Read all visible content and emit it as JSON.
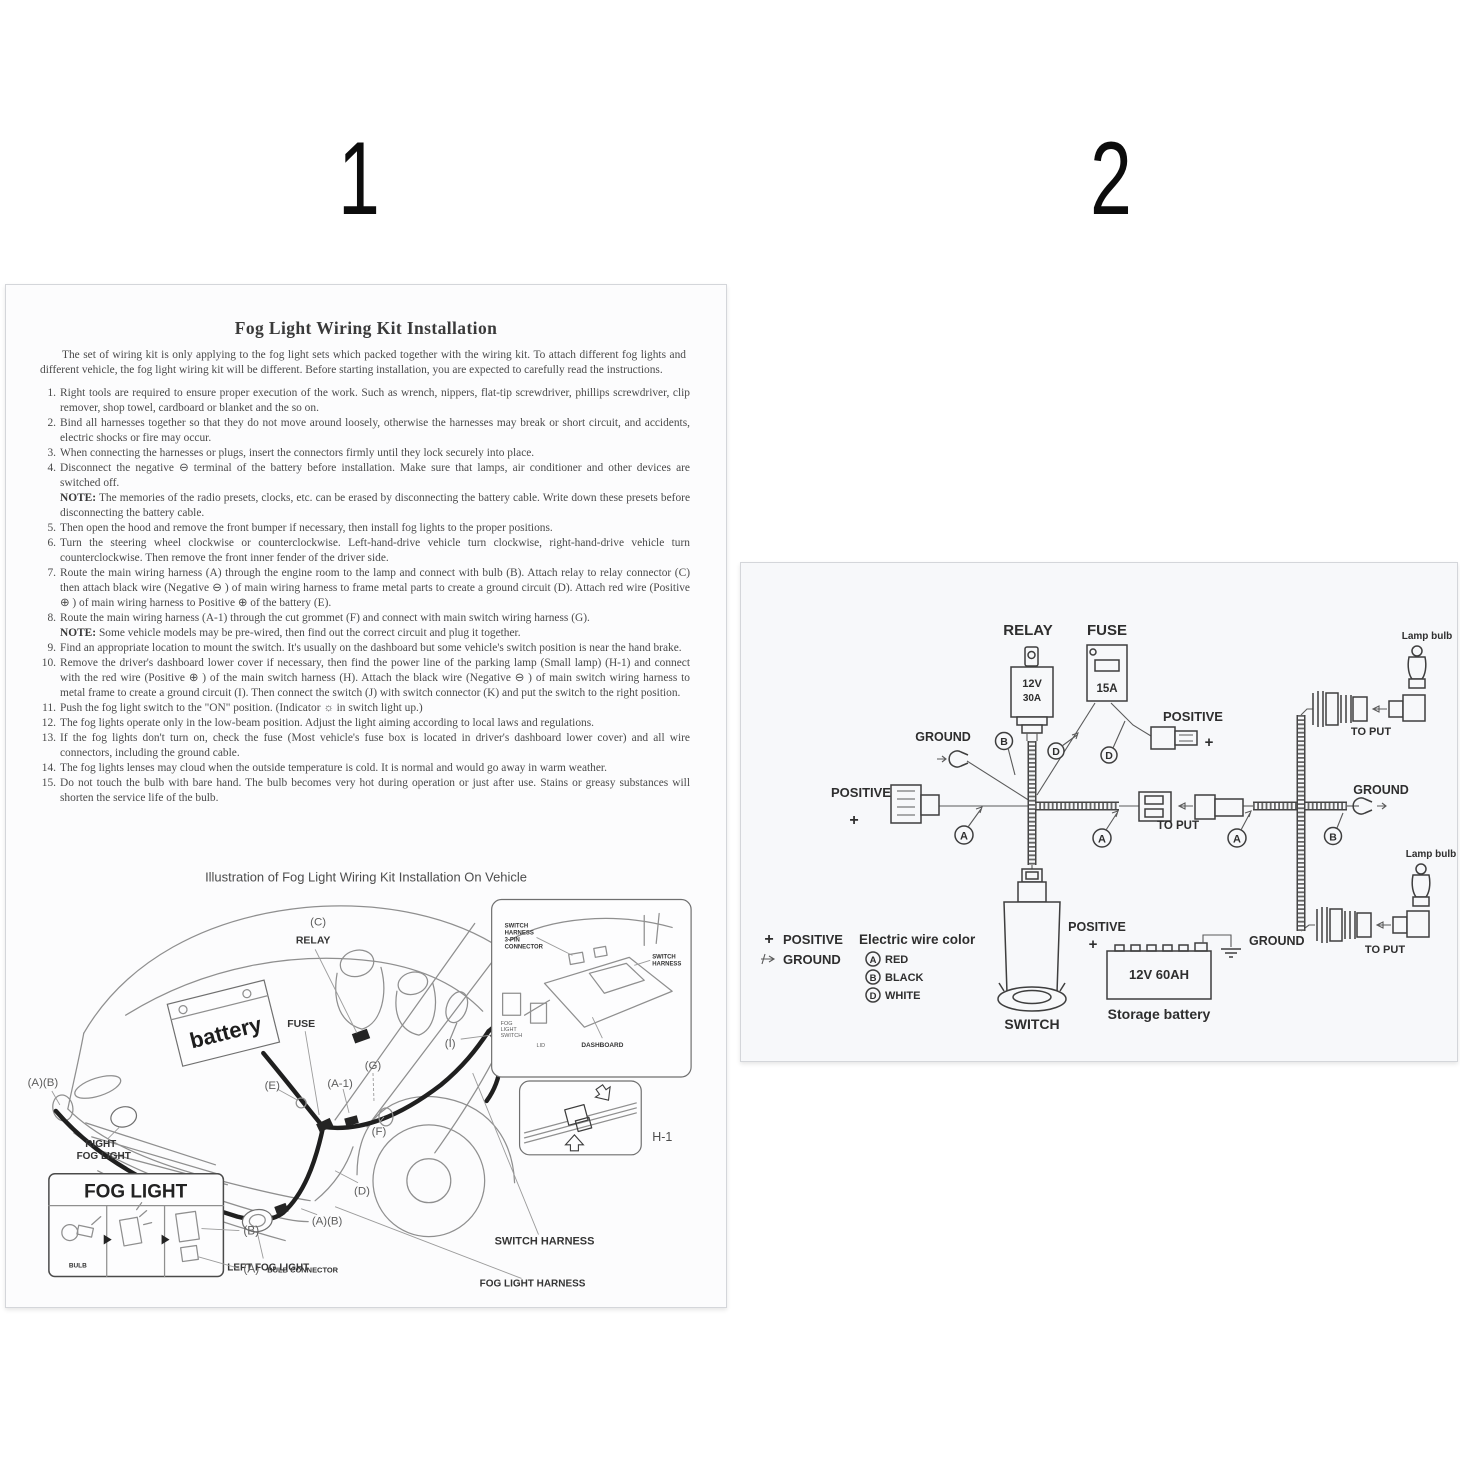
{
  "page1": {
    "page_number": "1",
    "title": "Fog Light Wiring Kit Installation",
    "intro": "The set of wiring kit is only applying to the fog light sets which packed together with the wiring kit. To attach different fog lights and different vehicle, the fog light wiring kit will be different. Before starting installation, you are expected to carefully read the instructions.",
    "note_label": "NOTE:",
    "steps": [
      {
        "num": "1.",
        "text": "Right tools are required to ensure proper execution of the work. Such as wrench, nippers, flat-tip screwdriver, phillips screwdriver, clip remover, shop towel, cardboard or blanket and the so on."
      },
      {
        "num": "2.",
        "text": "Bind all harnesses together so that they do not move around loosely, otherwise the harnesses may break or short circuit, and accidents, electric shocks or fire may occur."
      },
      {
        "num": "3.",
        "text": "When connecting the harnesses or plugs, insert the connectors firmly until they lock securely into place."
      },
      {
        "num": "4.",
        "text": "Disconnect the negative ⊖ terminal of the battery before installation. Make sure that lamps, air conditioner and other devices are switched off.",
        "note": "The memories of the radio presets, clocks, etc. can be erased by disconnecting the battery cable. Write down these presets before disconnecting the battery cable."
      },
      {
        "num": "5.",
        "text": "Then open the hood and remove the front bumper if necessary, then install fog lights to the proper positions."
      },
      {
        "num": "6.",
        "text": "Turn the steering wheel clockwise or counterclockwise. Left-hand-drive vehicle turn clockwise, right-hand-drive vehicle turn counterclockwise. Then remove the front inner fender of the driver side."
      },
      {
        "num": "7.",
        "text": "Route the main wiring harness (A) through the engine room to the lamp and connect with bulb (B). Attach relay to relay connector (C) then attach black wire (Negative ⊖ ) of main wiring harness to frame metal parts to create a ground circuit (D). Attach red wire (Positive ⊕ ) of main wiring harness to Positive ⊕ of the battery (E)."
      },
      {
        "num": "8.",
        "text": "Route the main wiring harness (A-1) through the cut grommet (F) and connect with main switch wiring harness (G).",
        "note": "Some vehicle models may be pre-wired, then find out the correct circuit and plug it together."
      },
      {
        "num": "9.",
        "text": "Find an appropriate location to mount the switch. It's usually on the dashboard but some vehicle's switch position is near the hand brake."
      },
      {
        "num": "10.",
        "text": "Remove the driver's dashboard lower cover if necessary, then find the power line of the parking lamp (Small lamp) (H-1) and connect with the red wire (Positive ⊕ ) of the main switch harness (H). Attach the black wire (Negative ⊖ ) of main switch wiring harness to metal frame to create a ground circuit (I). Then connect the switch (J) with switch connector (K) and put the switch to the right position."
      },
      {
        "num": "11.",
        "text": "Push the fog light switch to the \"ON\" position. (Indicator ☼ in switch light up.)"
      },
      {
        "num": "12.",
        "text": "The fog lights operate only in the low-beam position. Adjust the light aiming according to local laws and regulations."
      },
      {
        "num": "13.",
        "text": "If the fog lights don't turn on, check the fuse (Most vehicle's fuse box is located in driver's dashboard lower cover) and all wire connectors, including the ground cable."
      },
      {
        "num": "14.",
        "text": "The fog lights lenses may cloud when the outside temperature is cold. It is normal and would go away in warm weather."
      },
      {
        "num": "15.",
        "text": "Do not touch the bulb with bare hand. The bulb becomes very hot during operation or just after use. Stains or greasy substances will shorten the service life of the bulb."
      }
    ],
    "illustration": {
      "heading": "Illustration of Fog Light Wiring Kit Installation On Vehicle",
      "labels": {
        "c": "(C)",
        "relay": "RELAY",
        "battery": "battery",
        "fuse": "FUSE",
        "e": "(E)",
        "a1": "(A-1)",
        "g": "(G)",
        "f": "(F)",
        "d": "(D)",
        "ab": "(A)(B)",
        "j": "(J)",
        "k": "(K)",
        "i": "(I)",
        "h": "(H)",
        "h1": "H-1",
        "right_fog_light": [
          "RIGHT",
          "FOG LIGHT"
        ],
        "left_fog_light": "LEFT FOG LIGHT",
        "switch_harness": "SWITCH HARNESS",
        "fog_light_harness": "FOG LIGHT HARNESS"
      },
      "inset_dashboard": {
        "connector": [
          "SWITCH",
          "HARNESS",
          "3-PIN",
          "CONNECTOR"
        ],
        "switch_harness": [
          "SWITCH",
          "HARNESS"
        ],
        "dashboard": "DASHBOARD",
        "fog_light_switch": [
          "FOG",
          "LIGHT",
          "SWITCH"
        ],
        "lid": "LID"
      },
      "fog_light_box": {
        "title": "FOG LIGHT",
        "bulb": "BULB",
        "b": "(B)",
        "a": "(A)",
        "a_caption": "BULB CONNECTOR"
      }
    }
  },
  "page2": {
    "page_number": "2",
    "diagram": {
      "relay": "RELAY",
      "relay_v": "12V",
      "relay_a": "30A",
      "fuse": "FUSE",
      "fuse_a": "15A",
      "lamp_bulb": "Lamp bulb",
      "to_put": "TO PUT",
      "positive": "POSITIVE",
      "ground": "GROUND",
      "switch": "SWITCH",
      "battery_rating": "12V  60AH",
      "battery_caption": "Storage battery",
      "wire_a": "A",
      "wire_b": "B",
      "wire_d": "D",
      "legend": {
        "positive": "POSITIVE",
        "ground": "GROUND",
        "title": "Electric wire color",
        "a": "A",
        "a_color": "RED",
        "b": "B",
        "b_color": "BLACK",
        "d": "D",
        "d_color": "WHITE"
      }
    }
  }
}
